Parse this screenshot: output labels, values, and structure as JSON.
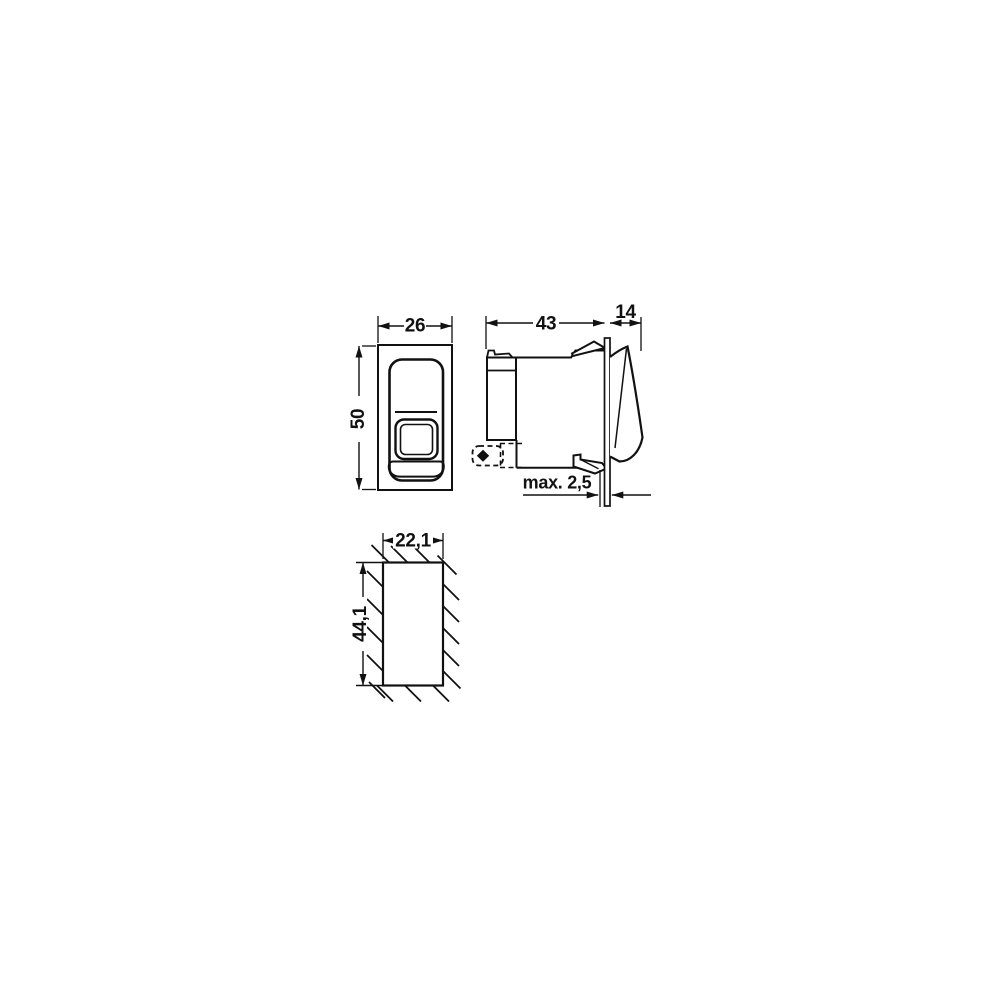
{
  "dimensions": {
    "front_width": "26",
    "front_height": "50",
    "side_depth": "43",
    "side_front_depth": "14",
    "panel_thickness_max": "max. 2,5",
    "cutout_width": "22,1",
    "cutout_height": "44,1"
  },
  "colors": {
    "line": "#111111",
    "background": "#ffffff"
  }
}
